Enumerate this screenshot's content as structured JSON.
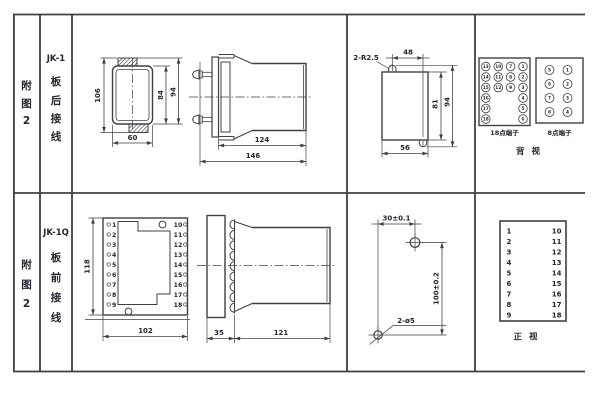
{
  "colors": {
    "line": "#3f4045",
    "text": "#23262e",
    "background": "#ffffff"
  },
  "left_rail": {
    "top": {
      "figure": [
        "附",
        "图",
        "2"
      ],
      "model": "JK-1",
      "wiring": [
        "板",
        "后",
        "接",
        "线"
      ]
    },
    "bottom": {
      "figure": [
        "附",
        "图",
        "2"
      ],
      "model": "JK-1Q",
      "wiring": [
        "板",
        "前",
        "接",
        "线"
      ]
    }
  },
  "rear_view": {
    "overall_h": "106",
    "case_h": "84",
    "tab_h": "94",
    "width": "60"
  },
  "side_rear": {
    "body": "124",
    "total": "146"
  },
  "cutout": {
    "note": "2-R2.5",
    "span": "48",
    "inner_h": "81",
    "outer_h": "94",
    "width": "56"
  },
  "back_view": {
    "t18_label": "18点端子",
    "t8_label": "8点端子",
    "caption": "背 视",
    "t18_col1": [
      "13",
      "14",
      "15",
      "16",
      "17",
      "18"
    ],
    "t18_col2": [
      "10",
      "11",
      "12"
    ],
    "t18_col3": [
      "7",
      "8",
      "9"
    ],
    "t18_col4": [
      "1",
      "2",
      "3",
      "4",
      "5",
      "6"
    ],
    "t8_left": [
      "5",
      "6",
      "7",
      "8"
    ],
    "t8_right": [
      "1",
      "2",
      "3",
      "4"
    ]
  },
  "front_plate": {
    "height": "118",
    "width": "102",
    "left": [
      "1",
      "2",
      "3",
      "4",
      "5",
      "6",
      "7",
      "8",
      "9"
    ],
    "right": [
      "10",
      "11",
      "12",
      "13",
      "14",
      "15",
      "16",
      "17",
      "18"
    ]
  },
  "side_front": {
    "front": "35",
    "body": "121"
  },
  "drill": {
    "x_span": "30±0.1",
    "y_span": "100±0.2",
    "holes": "2-ø5"
  },
  "front_view": {
    "caption": "正 视",
    "left": [
      "1",
      "2",
      "3",
      "4",
      "5",
      "6",
      "7",
      "8",
      "9"
    ],
    "right": [
      "10",
      "11",
      "12",
      "13",
      "14",
      "15",
      "16",
      "17",
      "18"
    ]
  }
}
